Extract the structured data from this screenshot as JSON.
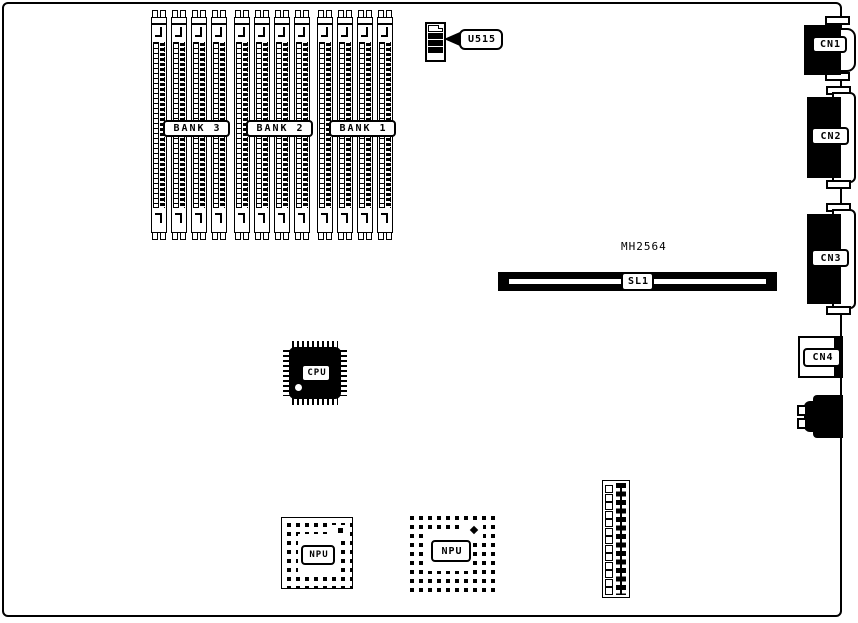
{
  "colors": {
    "ink": "#000000",
    "background": "#ffffff"
  },
  "memory": {
    "banks": [
      {
        "label": "BANK 3",
        "slots": 4
      },
      {
        "label": "BANK 2",
        "slots": 4
      },
      {
        "label": "BANK 1",
        "slots": 4
      }
    ]
  },
  "u515": {
    "label": "U515"
  },
  "rear_connectors": {
    "cn1": {
      "label": "CN1"
    },
    "cn2": {
      "label": "CN2"
    },
    "cn3": {
      "label": "CN3"
    },
    "cn4": {
      "label": "CN4"
    }
  },
  "expansion_slot": {
    "label": "SL1",
    "part_number": "MH2564"
  },
  "cpu": {
    "label": "CPU"
  },
  "npu_left": {
    "label": "NPU"
  },
  "npu_right": {
    "label": "NPU"
  },
  "bottom_header": {
    "pin_rows": 13
  }
}
